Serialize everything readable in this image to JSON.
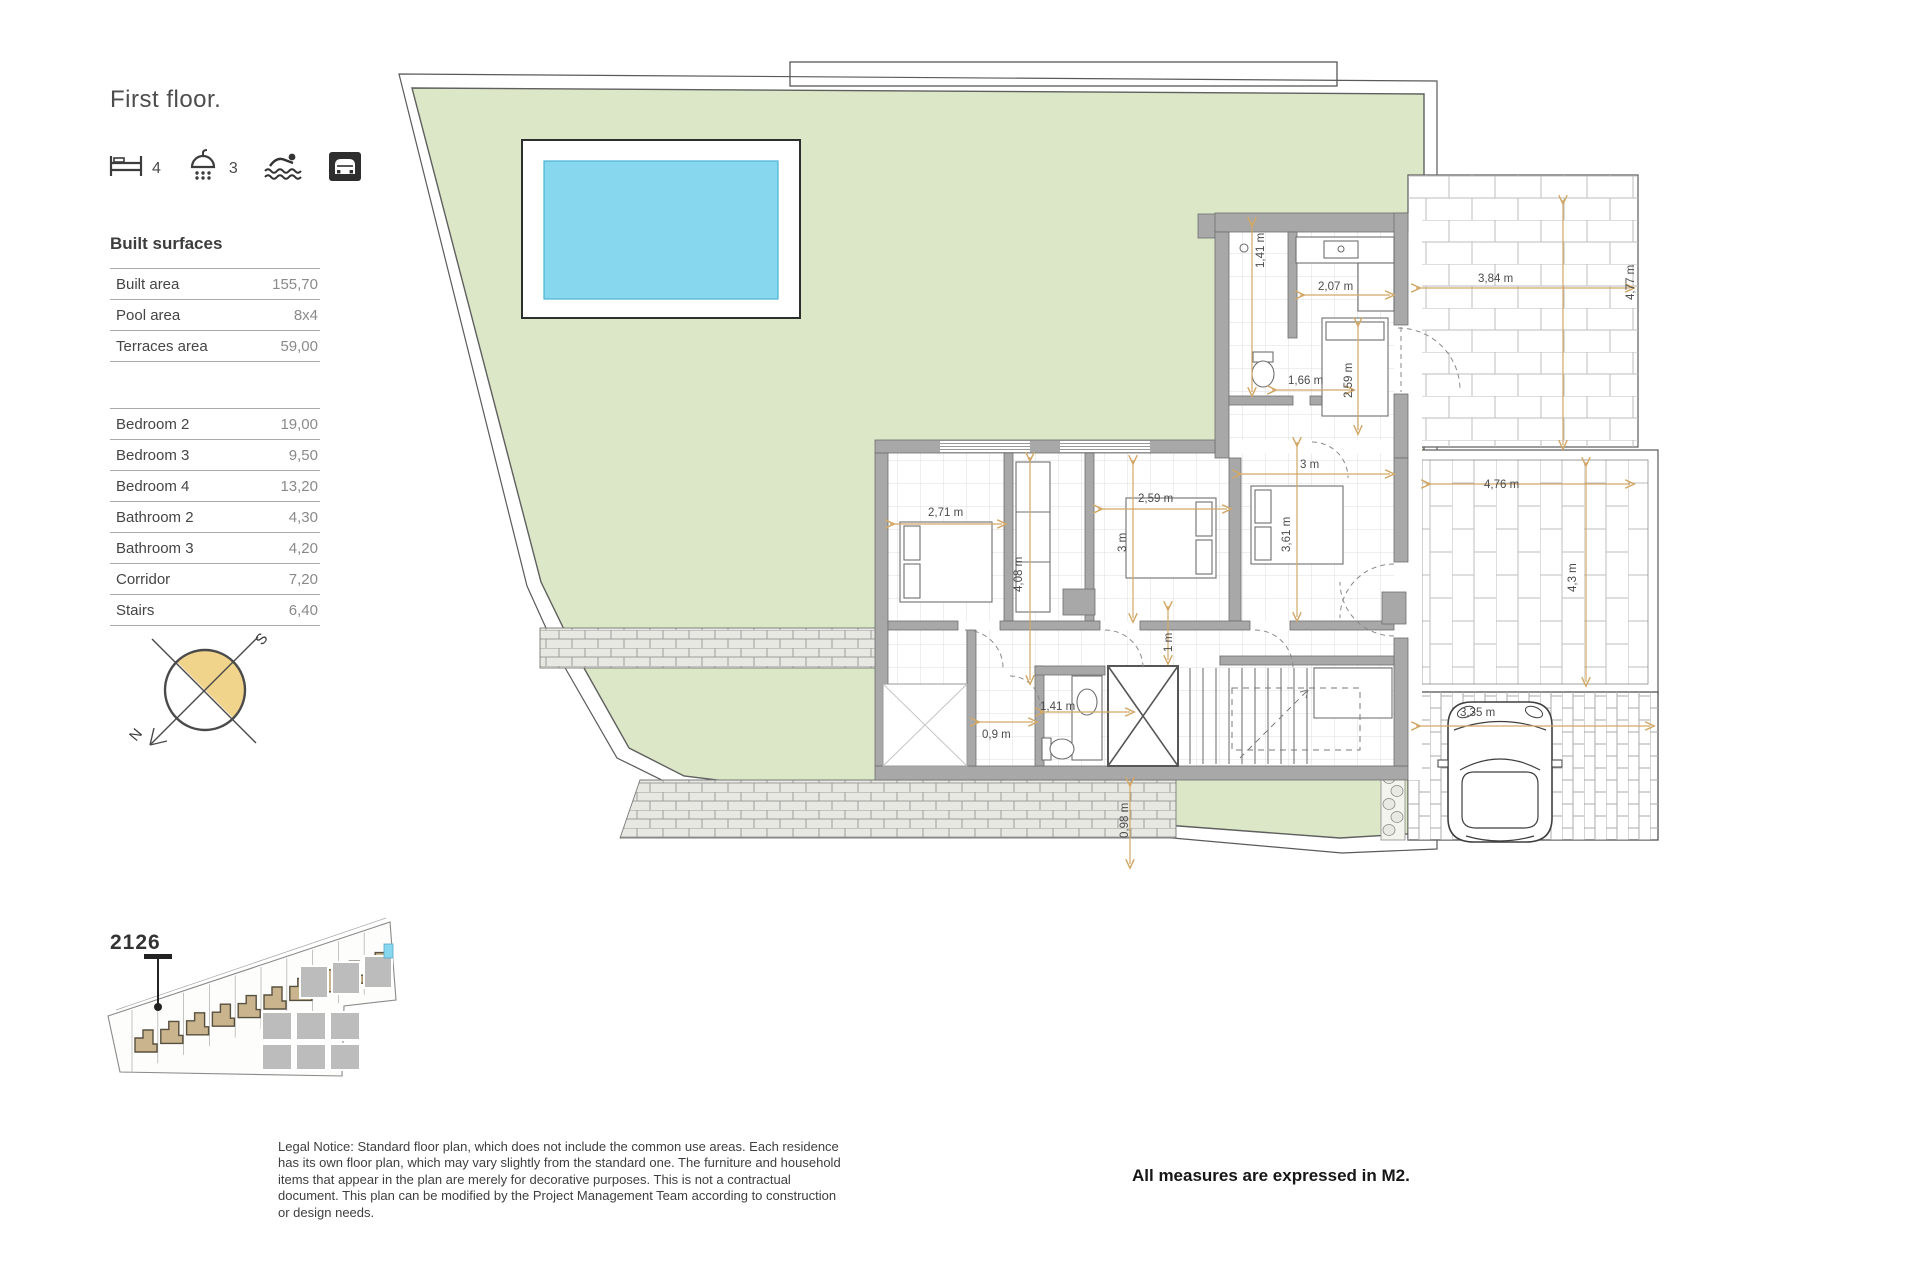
{
  "page": {
    "title": "First floor."
  },
  "amenities": {
    "bed_count": "4",
    "shower_count": "3"
  },
  "built_surfaces": {
    "heading": "Built surfaces",
    "rows": [
      {
        "label": "Built area",
        "value": "155,70"
      },
      {
        "label": "Pool area",
        "value": "8x4"
      },
      {
        "label": "Terraces area",
        "value": "59,00"
      }
    ]
  },
  "rooms": {
    "rows": [
      {
        "label": "Bedroom 2",
        "value": "19,00"
      },
      {
        "label": "Bedroom 3",
        "value": "9,50"
      },
      {
        "label": "Bedroom 4",
        "value": "13,20"
      },
      {
        "label": "Bathroom 2",
        "value": "4,30"
      },
      {
        "label": "Bathroom 3",
        "value": "4,20"
      },
      {
        "label": "Corridor",
        "value": "7,20"
      },
      {
        "label": "Stairs",
        "value": "6,40"
      }
    ]
  },
  "compass": {
    "north": "N",
    "south": "S"
  },
  "site_plan": {
    "unit_label": "2126"
  },
  "floor_plan": {
    "dimensions": [
      {
        "text": "1,41 m",
        "x": 1264,
        "y": 268,
        "rot": -90
      },
      {
        "text": "2,07 m",
        "x": 1318,
        "y": 290,
        "rot": 0
      },
      {
        "text": "3,84 m",
        "x": 1478,
        "y": 282,
        "rot": 0
      },
      {
        "text": "4,77 m",
        "x": 1634,
        "y": 300,
        "rot": -90
      },
      {
        "text": "1,66 m",
        "x": 1288,
        "y": 384,
        "rot": 0
      },
      {
        "text": "2,59 m",
        "x": 1352,
        "y": 398,
        "rot": -90
      },
      {
        "text": "3 m",
        "x": 1300,
        "y": 468,
        "rot": 0
      },
      {
        "text": "2,71 m",
        "x": 928,
        "y": 516,
        "rot": 0
      },
      {
        "text": "2,59 m",
        "x": 1138,
        "y": 502,
        "rot": 0
      },
      {
        "text": "3 m",
        "x": 1126,
        "y": 552,
        "rot": -90
      },
      {
        "text": "4,08 m",
        "x": 1022,
        "y": 592,
        "rot": -90
      },
      {
        "text": "3,61 m",
        "x": 1290,
        "y": 552,
        "rot": -90
      },
      {
        "text": "4,76 m",
        "x": 1484,
        "y": 488,
        "rot": 0
      },
      {
        "text": "4,3 m",
        "x": 1576,
        "y": 592,
        "rot": -90
      },
      {
        "text": "0,9 m",
        "x": 982,
        "y": 738,
        "rot": 0
      },
      {
        "text": "1,41 m",
        "x": 1040,
        "y": 710,
        "rot": 0
      },
      {
        "text": "1 m",
        "x": 1172,
        "y": 652,
        "rot": -90
      },
      {
        "text": "0,98 m",
        "x": 1128,
        "y": 838,
        "rot": -90
      },
      {
        "text": "3,35 m",
        "x": 1460,
        "y": 716,
        "rot": 0
      }
    ]
  },
  "footer": {
    "legal_notice": "Legal Notice: Standard floor plan, which does not include the common use areas. Each residence has its own floor plan, which may vary slightly from the standard one. The furniture and household items that appear in the plan are merely for decorative purposes. This is not a contractual document. This plan can be modified by the Project Management Team according to construction or design needs.",
    "measures_note": "All measures are expressed in M2."
  },
  "colors": {
    "plot_green": "#dbe7c6",
    "pool_blue": "#87d7ef",
    "dimension_accent": "#d2a868",
    "compass_yellow": "#f0d48c",
    "site_house_tan": "#c9b48e",
    "wall_gray": "#a8a8a8"
  }
}
